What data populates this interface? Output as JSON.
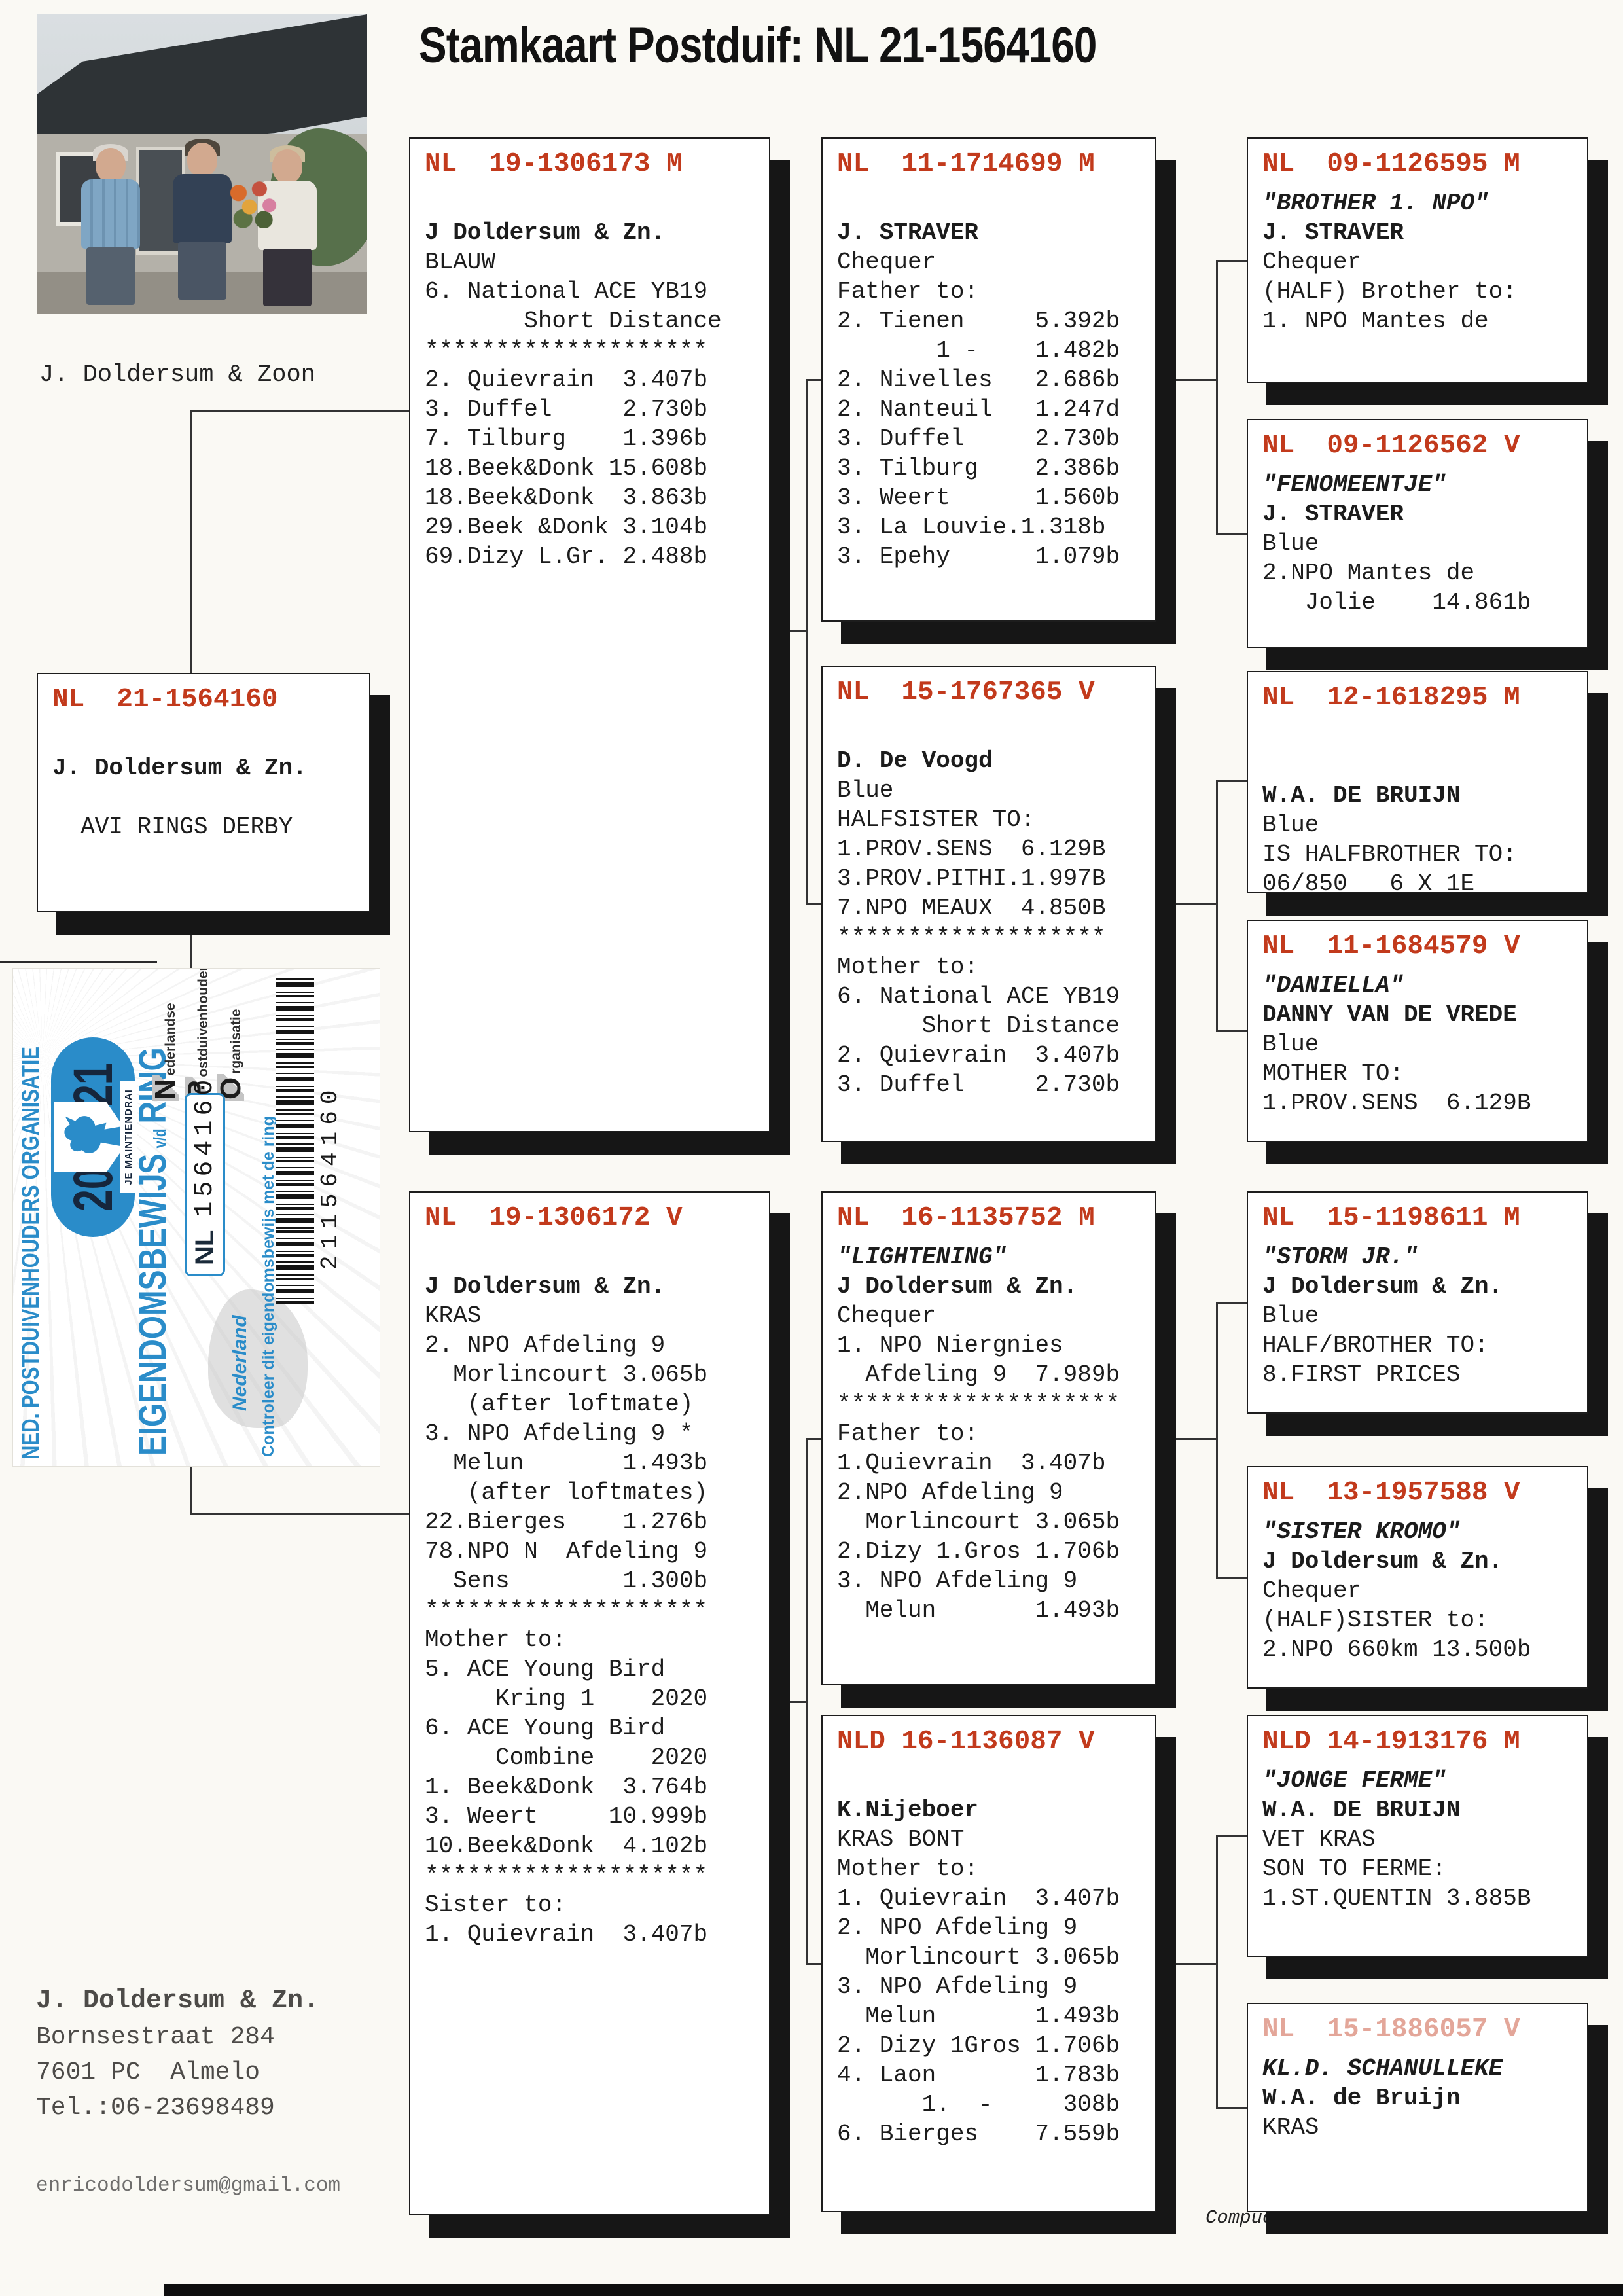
{
  "title": "Stamkaart Postduif: NL  21-1564160",
  "photo_caption": "J. Doldersum & Zoon",
  "address": {
    "name": "J. Doldersum & Zn.",
    "line1": "Bornsestraat 284",
    "line2": "7601 PC  Almelo",
    "line3": "Tel.:06-23698489",
    "email": "enricodoldersum@gmail.com"
  },
  "footer": {
    "date": "20-04-2021",
    "credit": "Compuclub © J. Doldersum & Zn."
  },
  "colors": {
    "ring_red": "#c23a1c",
    "sticker_blue": "#2a8cc9",
    "shadow_black": "#161616"
  },
  "sticker": {
    "org": "NED. POSTDUIVENHOUDERS ORGANISATIE",
    "year_left": "20",
    "year_right": "21",
    "motto": "JE MAINTIENDRAI",
    "title_main": "EIGENDOMSBEWIJS",
    "title_small": "v/d",
    "title_end": "RING",
    "npo": [
      {
        "initial": "N",
        "rest": "ederlandse"
      },
      {
        "initial": "P",
        "rest": "ostduivenhouders"
      },
      {
        "initial": "O",
        "rest": "rganisatie"
      }
    ],
    "country_code": "NL",
    "ring_number": "1564160",
    "country": "Nederland",
    "check_text": "Controleer dit eigendomsbewijs met de ring",
    "barcode_number": "211564160"
  },
  "boxes": [
    {
      "key": "subject",
      "ring": "NL  21-1564160",
      "lines": [
        [
          ""
        ],
        [
          "J. Doldersum & Zn.",
          "b"
        ],
        [
          ""
        ],
        [
          "  AVI RINGS DERBY"
        ]
      ]
    },
    {
      "key": "father",
      "ring": "NL  19-1306173 M",
      "lines": [
        [
          ""
        ],
        [
          "J Doldersum & Zn.",
          "b"
        ],
        [
          "BLAUW"
        ],
        [
          "6. National ACE YB19"
        ],
        [
          "       Short Distance"
        ],
        [
          "********************"
        ],
        [
          "2. Quievrain  3.407b"
        ],
        [
          "3. Duffel     2.730b"
        ],
        [
          "7. Tilburg    1.396b"
        ],
        [
          "18.Beek&Donk 15.608b"
        ],
        [
          "18.Beek&Donk  3.863b"
        ],
        [
          "29.Beek &Donk 3.104b"
        ],
        [
          "69.Dizy L.Gr. 2.488b"
        ]
      ]
    },
    {
      "key": "mother",
      "ring": "NL  19-1306172 V",
      "lines": [
        [
          ""
        ],
        [
          "J Doldersum & Zn.",
          "b"
        ],
        [
          "KRAS"
        ],
        [
          "2. NPO Afdeling 9"
        ],
        [
          "  Morlincourt 3.065b"
        ],
        [
          "   (after loftmate)"
        ],
        [
          "3. NPO Afdeling 9 *"
        ],
        [
          "  Melun       1.493b"
        ],
        [
          "   (after loftmates)"
        ],
        [
          "22.Bierges    1.276b"
        ],
        [
          "78.NPO N  Afdeling 9"
        ],
        [
          "  Sens        1.300b"
        ],
        [
          "********************"
        ],
        [
          "Mother to:"
        ],
        [
          "5. ACE Young Bird"
        ],
        [
          "     Kring 1    2020"
        ],
        [
          "6. ACE Young Bird"
        ],
        [
          "     Combine    2020"
        ],
        [
          "1. Beek&Donk  3.764b"
        ],
        [
          "3. Weert     10.999b"
        ],
        [
          "10.Beek&Donk  4.102b"
        ],
        [
          "********************"
        ],
        [
          "Sister to:"
        ],
        [
          "1. Quievrain  3.407b"
        ]
      ]
    },
    {
      "key": "pgf",
      "ring": "NL  11-1714699 M",
      "lines": [
        [
          ""
        ],
        [
          "J. STRAVER",
          "b"
        ],
        [
          "Chequer"
        ],
        [
          "Father to:"
        ],
        [
          "2. Tienen     5.392b"
        ],
        [
          "       1 -    1.482b"
        ],
        [
          "2. Nivelles   2.686b"
        ],
        [
          "2. Nanteuil   1.247d"
        ],
        [
          "3. Duffel     2.730b"
        ],
        [
          "3. Tilburg    2.386b"
        ],
        [
          "3. Weert      1.560b"
        ],
        [
          "3. La Louvie.1.318b"
        ],
        [
          "3. Epehy      1.079b"
        ]
      ]
    },
    {
      "key": "pgm",
      "ring": "NL  15-1767365 V",
      "lines": [
        [
          ""
        ],
        [
          "D. De Voogd",
          "b"
        ],
        [
          "Blue"
        ],
        [
          "HALFSISTER TO:"
        ],
        [
          "1.PROV.SENS  6.129B"
        ],
        [
          "3.PROV.PITHI.1.997B"
        ],
        [
          "7.NPO MEAUX  4.850B"
        ],
        [
          "*******************"
        ],
        [
          "Mother to:"
        ],
        [
          "6. National ACE YB19"
        ],
        [
          "      Short Distance"
        ],
        [
          "2. Quievrain  3.407b"
        ],
        [
          "3. Duffel     2.730b"
        ]
      ]
    },
    {
      "key": "mgf",
      "ring": "NL  16-1135752 M",
      "lines": [
        [
          "\"LIGHTENING\"",
          "bi"
        ],
        [
          "J Doldersum & Zn.",
          "b"
        ],
        [
          "Chequer"
        ],
        [
          "1. NPO Niergnies"
        ],
        [
          "  Afdeling 9  7.989b"
        ],
        [
          "********************"
        ],
        [
          "Father to:"
        ],
        [
          "1.Quievrain  3.407b"
        ],
        [
          "2.NPO Afdeling 9"
        ],
        [
          "  Morlincourt 3.065b"
        ],
        [
          "2.Dizy 1.Gros 1.706b"
        ],
        [
          "3. NPO Afdeling 9"
        ],
        [
          "  Melun       1.493b"
        ]
      ]
    },
    {
      "key": "mgm",
      "ring": "NLD 16-1136087 V",
      "lines": [
        [
          ""
        ],
        [
          "K.Nijeboer",
          "b"
        ],
        [
          "KRAS BONT"
        ],
        [
          "Mother to:"
        ],
        [
          "1. Quievrain  3.407b"
        ],
        [
          "2. NPO Afdeling 9"
        ],
        [
          "  Morlincourt 3.065b"
        ],
        [
          "3. NPO Afdeling 9"
        ],
        [
          "  Melun       1.493b"
        ],
        [
          "2. Dizy 1Gros 1.706b"
        ],
        [
          "4. Laon       1.783b"
        ],
        [
          "      1.  -     308b"
        ],
        [
          "6. Bierges    7.559b"
        ]
      ]
    },
    {
      "key": "pgf-f",
      "ring": "NL  09-1126595 M",
      "lines": [
        [
          "\"BROTHER 1. NPO\"",
          "bi"
        ],
        [
          "J. STRAVER",
          "b"
        ],
        [
          "Chequer"
        ],
        [
          "(HALF) Brother to:"
        ],
        [
          "1. NPO Mantes de"
        ]
      ]
    },
    {
      "key": "pgf-m",
      "ring": "NL  09-1126562 V",
      "lines": [
        [
          "\"FENOMEENTJE\"",
          "bi"
        ],
        [
          "J. STRAVER",
          "b"
        ],
        [
          "Blue"
        ],
        [
          "2.NPO Mantes de"
        ],
        [
          "   Jolie    14.861b"
        ]
      ]
    },
    {
      "key": "pgm-f",
      "ring": "NL  12-1618295 M",
      "lines": [
        [
          ""
        ],
        [
          ""
        ],
        [
          "W.A. DE BRUIJN",
          "b"
        ],
        [
          "Blue"
        ],
        [
          "IS HALFBROTHER TO:"
        ],
        [
          "06/850   6 X 1E"
        ]
      ]
    },
    {
      "key": "pgm-m",
      "ring": "NL  11-1684579 V",
      "lines": [
        [
          "\"DANIELLA\"",
          "bi"
        ],
        [
          "DANNY VAN DE VREDE",
          "b"
        ],
        [
          "Blue"
        ],
        [
          "MOTHER TO:"
        ],
        [
          "1.PROV.SENS  6.129B"
        ]
      ]
    },
    {
      "key": "mgf-f",
      "ring": "NL  15-1198611 M",
      "lines": [
        [
          "\"STORM JR.\"",
          "bi"
        ],
        [
          "J Doldersum & Zn.",
          "b"
        ],
        [
          "Blue"
        ],
        [
          "HALF/BROTHER TO:"
        ],
        [
          "8.FIRST PRICES"
        ]
      ]
    },
    {
      "key": "mgf-m",
      "ring": "NL  13-1957588 V",
      "lines": [
        [
          "\"SISTER KROMO\"",
          "bi"
        ],
        [
          "J Doldersum & Zn.",
          "b"
        ],
        [
          "Chequer"
        ],
        [
          "(HALF)SISTER to:"
        ],
        [
          "2.NPO 660km 13.500b"
        ]
      ]
    },
    {
      "key": "mgm-f",
      "ring": "NLD 14-1913176 M",
      "lines": [
        [
          "\"JONGE FERME\"",
          "bi"
        ],
        [
          "W.A. DE BRUIJN",
          "b"
        ],
        [
          "VET KRAS"
        ],
        [
          "SON TO FERME:"
        ],
        [
          "1.ST.QUENTIN 3.885B"
        ]
      ]
    },
    {
      "key": "mgm-m",
      "ring": "NL  15-1886057 V",
      "faded": true,
      "lines": [
        [
          "KL.D. SCHANULLEKE",
          "bi"
        ],
        [
          "W.A. de Bruijn",
          "b"
        ],
        [
          "KRAS"
        ]
      ]
    }
  ]
}
